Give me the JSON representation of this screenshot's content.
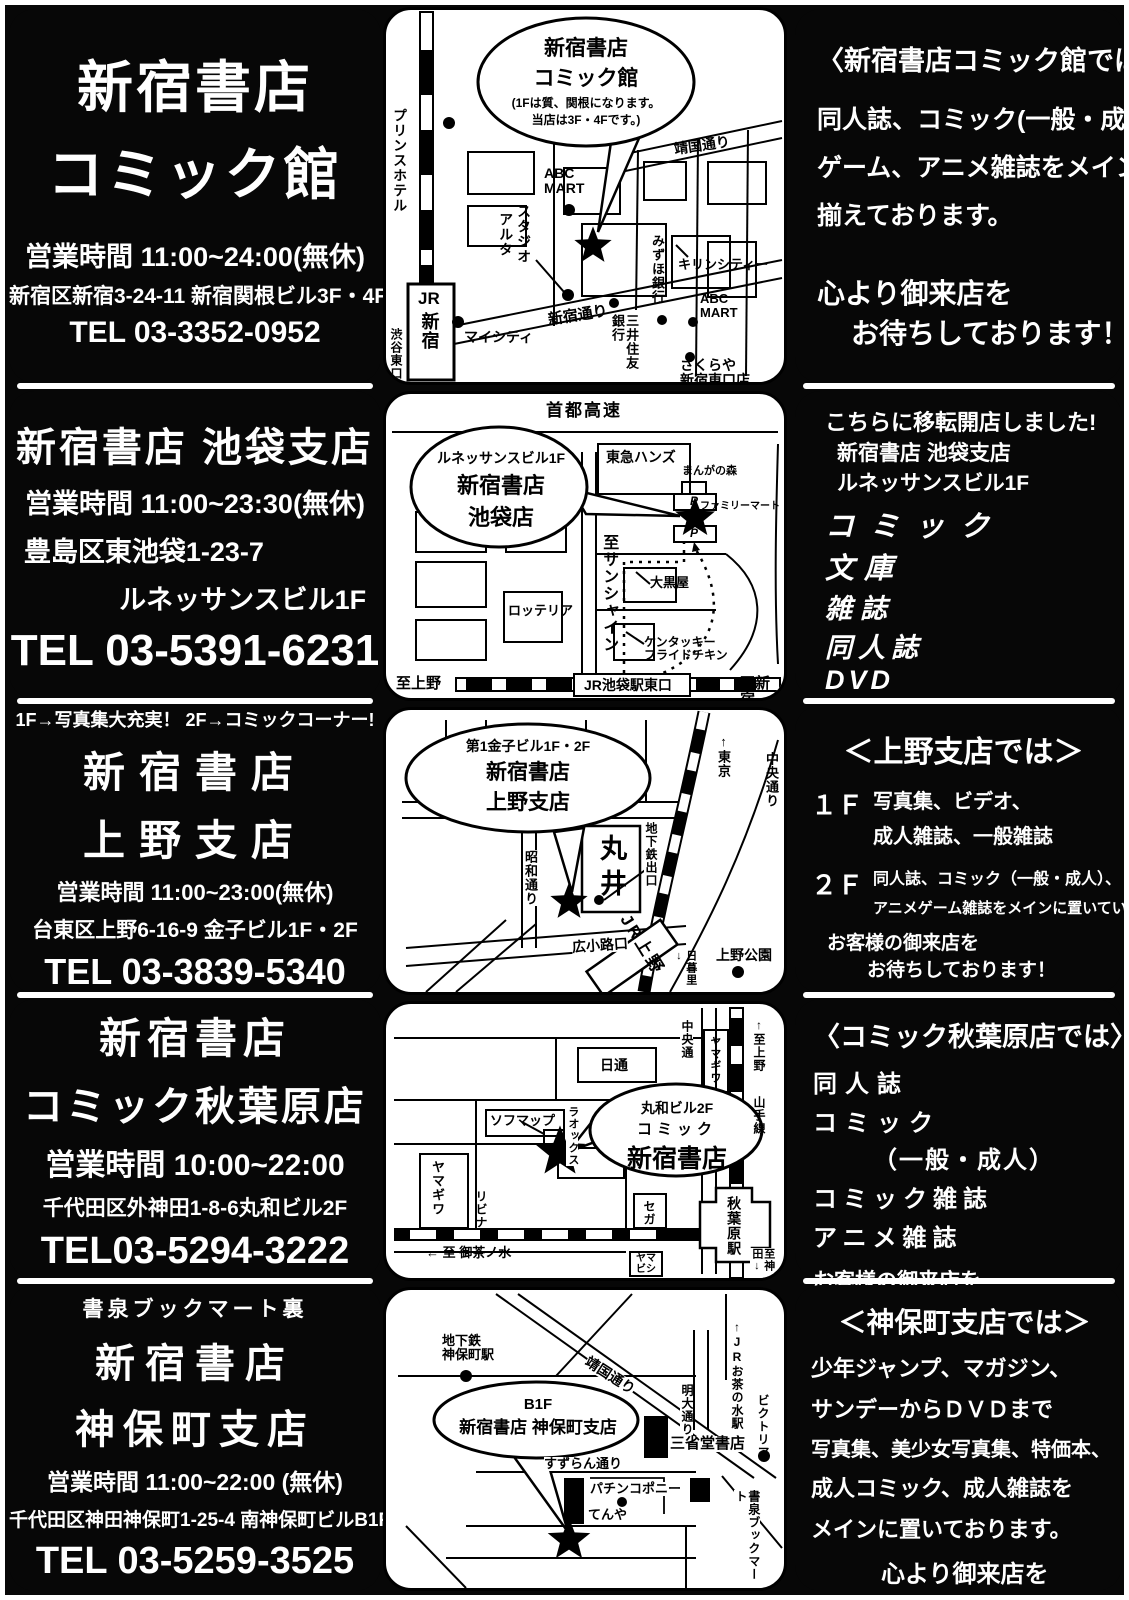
{
  "stores": [
    {
      "name1": "新宿書店",
      "name2": "コミック館",
      "hours": "営業時間 11:00~24:00(無休)",
      "address": "新宿区新宿3-24-11 新宿関根ビル3F・4F",
      "tel": "TEL 03-3352-0952"
    },
    {
      "name1": "新宿書店  池袋支店",
      "hours": "営業時間 11:00~23:30(無休)",
      "address": "豊島区東池袋1-23-7",
      "address2": "ルネッサンスビル1F",
      "tel": "TEL 03-5391-6231"
    },
    {
      "note": "1F→写真集大充実！ 2F→コミックコーナー!",
      "name1": "新宿書店",
      "name2": "上野支店",
      "hours": "営業時間 11:00~23:00(無休)",
      "address": "台東区上野6-16-9 金子ビル1F・2F",
      "tel": "TEL 03-3839-5340"
    },
    {
      "name1": "新宿書店",
      "name2": "コミック秋葉原店",
      "hours": "営業時間 10:00~22:00",
      "address": "千代田区外神田1-8-6丸和ビル2F",
      "tel": "TEL03-5294-3222"
    },
    {
      "note": "書泉ブックマート裏",
      "name1": "新宿書店",
      "name2": "神保町支店",
      "hours": "営業時間 11:00~22:00 (無休)",
      "address": "千代田区神田神保町1-25-4 南神保町ビルB1F",
      "tel": "TEL 03-5259-3525"
    }
  ],
  "info": [
    {
      "heading": "〈新宿書店コミック館では〉",
      "body": [
        "同人誌、コミック(一般・成人)",
        "ゲーム、アニメ雑誌をメインに",
        "揃えております。"
      ],
      "close1": "心より御来店を",
      "close2": "お待ちしております！"
    },
    {
      "intro": [
        "こちらに移転開店しました!",
        "新宿書店 池袋支店",
        "ルネッサンスビル1F"
      ],
      "items": [
        "コミック",
        "文庫",
        "雑誌",
        "同人誌",
        "DVD"
      ],
      "close1": "お客様の御来店を",
      "close2": "お待ちしております！"
    },
    {
      "heading": "＜上野支店では＞",
      "floor1": "１Ｆ",
      "floor1_text": [
        "写真集、ビデオ、",
        "成人雑誌、一般雑誌"
      ],
      "floor2": "２Ｆ",
      "floor2_text": [
        "同人誌、コミック（一般・成人）、",
        "アニメゲーム雑誌をメインに置いています。"
      ],
      "close1": "お客様の御来店を",
      "close2": "お待ちしております！"
    },
    {
      "heading": "〈コミック秋葉原店では〉",
      "items": [
        "同人誌",
        "コミック",
        "（一般・成人）",
        "コミック雑誌",
        "アニメ雑誌"
      ],
      "close1": "お客様の御来店を",
      "close2": "お待ちしております！"
    },
    {
      "heading": "＜神保町支店では＞",
      "body": [
        "少年ジャンプ、マガジン、",
        "サンデーからＤＶＤまで",
        "写真集、美少女写真集、特価本、",
        "成人コミック、成人雑誌を",
        "メインに置いております。"
      ],
      "close1": "心より御来店を",
      "close2": "お待ちしております！"
    }
  ],
  "maps": [
    {
      "balloon": [
        "新宿書店",
        "コミック館",
        "(1Fは質、関根になります。",
        "当店は3F・4Fです。)"
      ],
      "labels": {
        "prince": "プリンスホテル",
        "yasukuni": "靖国通り",
        "abc1": "ABC\nMART",
        "studio": "スタジオ",
        "alta": "アルタ",
        "mizuho": "みずほ銀行",
        "kirin": "キリンシティー",
        "abc2": "ABC\nMART",
        "shinjuku_dori": "新宿通り",
        "mitsui": "三井住友銀行",
        "mycity": "マイシティ",
        "jr": "JR",
        "sta": "新宿",
        "shibuya": "渋谷東口",
        "sakuraya": "さくらや\n新宿東口店"
      }
    },
    {
      "balloon": [
        "ルネッサンスビル1F",
        "新宿書店",
        "池袋店"
      ],
      "labels": {
        "shuto": "首都高速",
        "hands": "東急ハンズ",
        "manga": "まんがの森",
        "famima": "ファミリーマート",
        "p1": "P",
        "p2": "P",
        "sunshine": "至サンシャイン",
        "daikoku": "大黒屋",
        "lotteria": "ロッテリア",
        "kfc": "ケンタッキー\nフライドチキン",
        "ueno": "至上野",
        "station": "JR池袋駅東口",
        "shinjuku": "至新宿"
      }
    },
    {
      "balloon": [
        "第1金子ビル1F・2F",
        "新宿書店",
        "上野支店"
      ],
      "labels": {
        "tokyo": "↑東京",
        "chuo": "中央通り",
        "showa": "昭和通り",
        "marui": "丸井",
        "subway": "地下鉄出口",
        "hirokoji": "広小路口",
        "jr_ueno": "JR上野",
        "nippori": "日暮里↓",
        "ueno_park": "上野公園"
      }
    },
    {
      "balloon": [
        "丸和ビル2F",
        "コミック",
        "新宿書店"
      ],
      "labels": {
        "chuo": "中央通",
        "yamagiwa1": "ヤマギワ",
        "ueno": "↑至上野",
        "yamanote": "山手線",
        "nittsu": "日通",
        "sofmap": "ソフマップ",
        "laox": "ラオックス",
        "yamagiwa2": "ヤマギワ",
        "livina": "リビナ",
        "sega": "セガ",
        "station": "秋葉原駅",
        "ochanomizu": "← 至 御茶ノ水",
        "yamabishi": "ヤマ\nビシ",
        "kanda": "至神田↓"
      }
    },
    {
      "balloon": [
        "B1F",
        "新宿書店  神保町支店"
      ],
      "labels": {
        "subway": "地下鉄\n神保町駅",
        "yasukuni": "靖国通り",
        "jr": "↑JRお茶の水駅",
        "meidai": "明大通り",
        "victoria": "ビクトリア",
        "sanseido": "三省堂書店",
        "suzuran": "すずらん通り",
        "pachinko": "パチンコポニー",
        "tenya": "てんや",
        "shosen": "書泉ブックマート"
      }
    }
  ]
}
